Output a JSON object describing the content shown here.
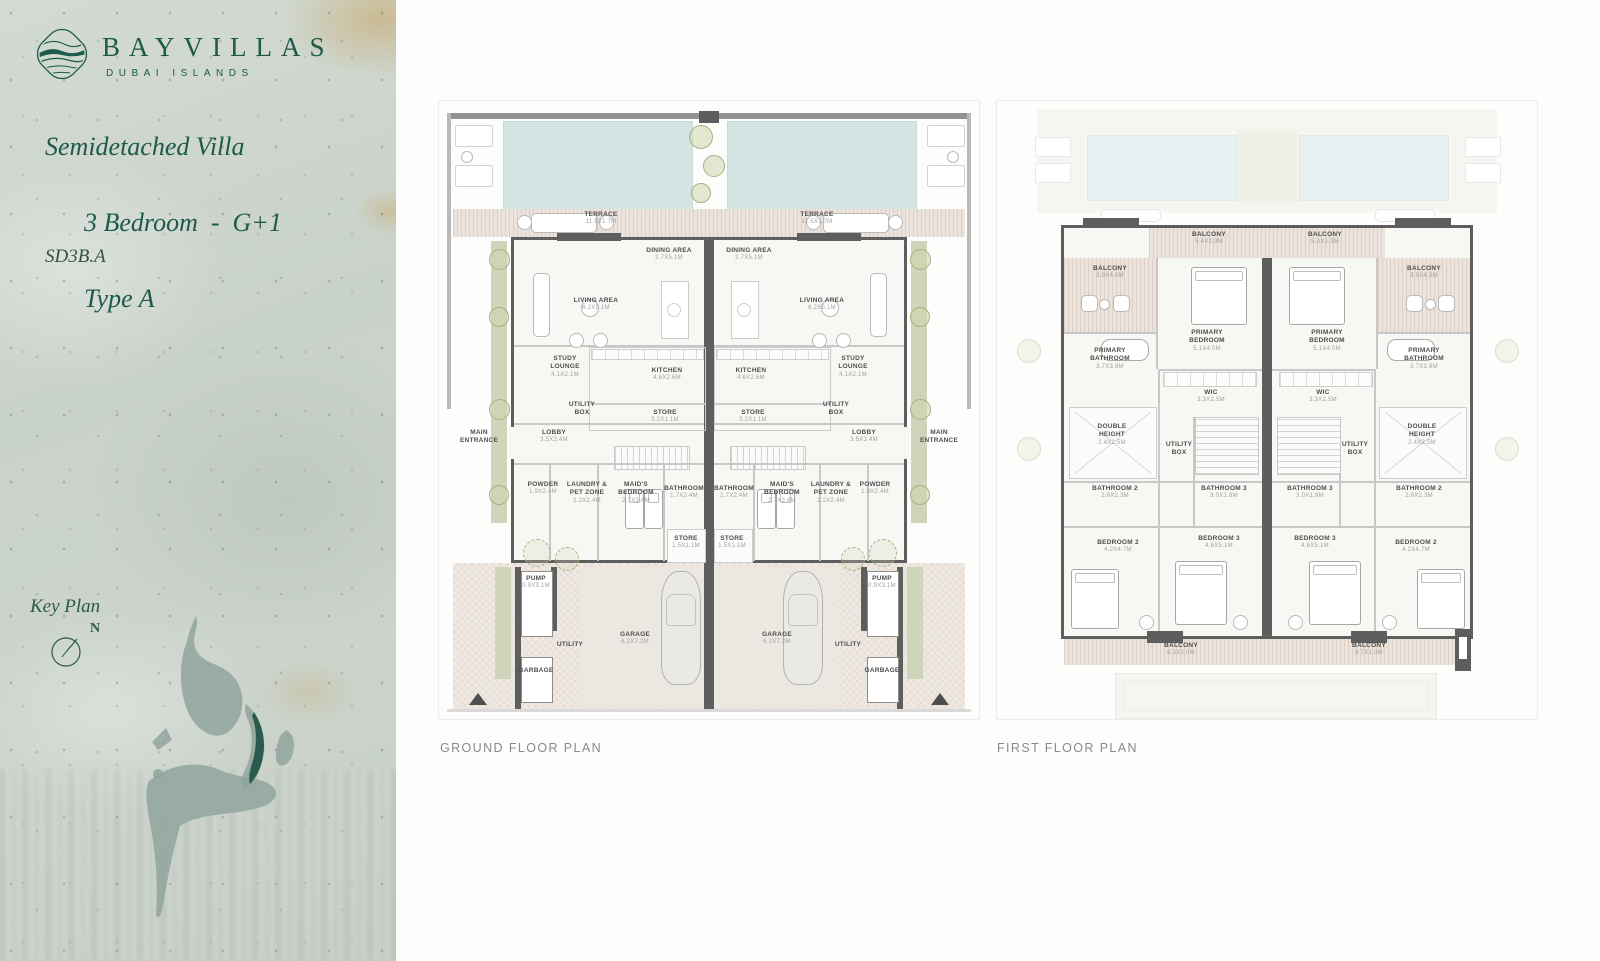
{
  "brand": {
    "name": "BAYVILLAS",
    "tagline": "DUBAI ISLANDS"
  },
  "title": {
    "line1": "Semidetached Villa",
    "line2": "3 Bedroom  -  G+1",
    "line3": "Type A",
    "code": "SD3B.A"
  },
  "key_plan": {
    "label": "Key Plan",
    "north": "N"
  },
  "captions": {
    "ground": "GROUND FLOOR PLAN",
    "first": "FIRST FLOOR PLAN"
  },
  "colors": {
    "brand_green": "#1d5a4a",
    "map_green": "#2b5b4c",
    "wall_grey": "#5e5e5e",
    "pool_blue": "#d3e6e4"
  },
  "gf": {
    "terrace": {
      "name": "TERRACE",
      "dim": "11.5X1.7M"
    },
    "dining": {
      "name": "DINING AREA",
      "dim": "2.7X5.1M"
    },
    "living": {
      "name": "LIVING AREA",
      "dim": "6.2X5.1M"
    },
    "study": {
      "name": "STUDY LOUNGE",
      "dim": "4.1X2.1M"
    },
    "kitchen": {
      "name": "KITCHEN",
      "dim": "4.6X2.6M"
    },
    "utility_box": {
      "name": "UTILITY BOX"
    },
    "store1": {
      "name": "STORE",
      "dim": "3.2X1.1M"
    },
    "lobby": {
      "name": "LOBBY",
      "dim": "3.5X3.4M"
    },
    "main_entrance": {
      "name": "MAIN ENTRANCE"
    },
    "powder": {
      "name": "POWDER",
      "dim": "1.9X2.4M"
    },
    "laundry": {
      "name": "LAUNDRY & PET ZONE",
      "dim": "2.2X2.4M"
    },
    "maids": {
      "name": "MAID'S BEDROOM",
      "dim": "2.7X3.6M"
    },
    "bathroom": {
      "name": "BATHROOM",
      "dim": "1.7X2.4M"
    },
    "store2": {
      "name": "STORE",
      "dim": "1.5X1.1M"
    },
    "pump": {
      "name": "PUMP",
      "dim": "0.9X3.1M"
    },
    "garage": {
      "name": "GARAGE",
      "dim": "6.2X7.2M"
    },
    "utility": {
      "name": "UTILITY"
    },
    "garbage": {
      "name": "GARBAGE"
    }
  },
  "ff": {
    "balcony_top": {
      "name": "BALCONY",
      "dim": "5.4X1.3M"
    },
    "balcony_side": {
      "name": "BALCONY",
      "dim": "3.9X4.0M"
    },
    "primary_bedroom": {
      "name": "PRIMARY BEDROOM",
      "dim": "5.1X4.0M"
    },
    "primary_bathroom": {
      "name": "PRIMARY BATHROOM",
      "dim": "3.7X3.9M"
    },
    "wic": {
      "name": "WIC",
      "dim": "3.3X2.5M"
    },
    "double_height": {
      "name": "DOUBLE HEIGHT",
      "dim": "2.4X2.5M"
    },
    "utility_box": {
      "name": "UTILITY BOX"
    },
    "bathroom2": {
      "name": "BATHROOM 2",
      "dim": "2.9X2.3M"
    },
    "bathroom3": {
      "name": "BATHROOM 3",
      "dim": "3.0X1.8M"
    },
    "bedroom2": {
      "name": "BEDROOM 2",
      "dim": "4.2X4.7M"
    },
    "bedroom3": {
      "name": "BEDROOM 3",
      "dim": "4.6X5.1M"
    },
    "balcony_bottom_left": {
      "name": "BALCONY",
      "dim": "9.3X1.0M"
    },
    "balcony_bottom_right": {
      "name": "BALCONY",
      "dim": "8.7X1.0M"
    }
  }
}
